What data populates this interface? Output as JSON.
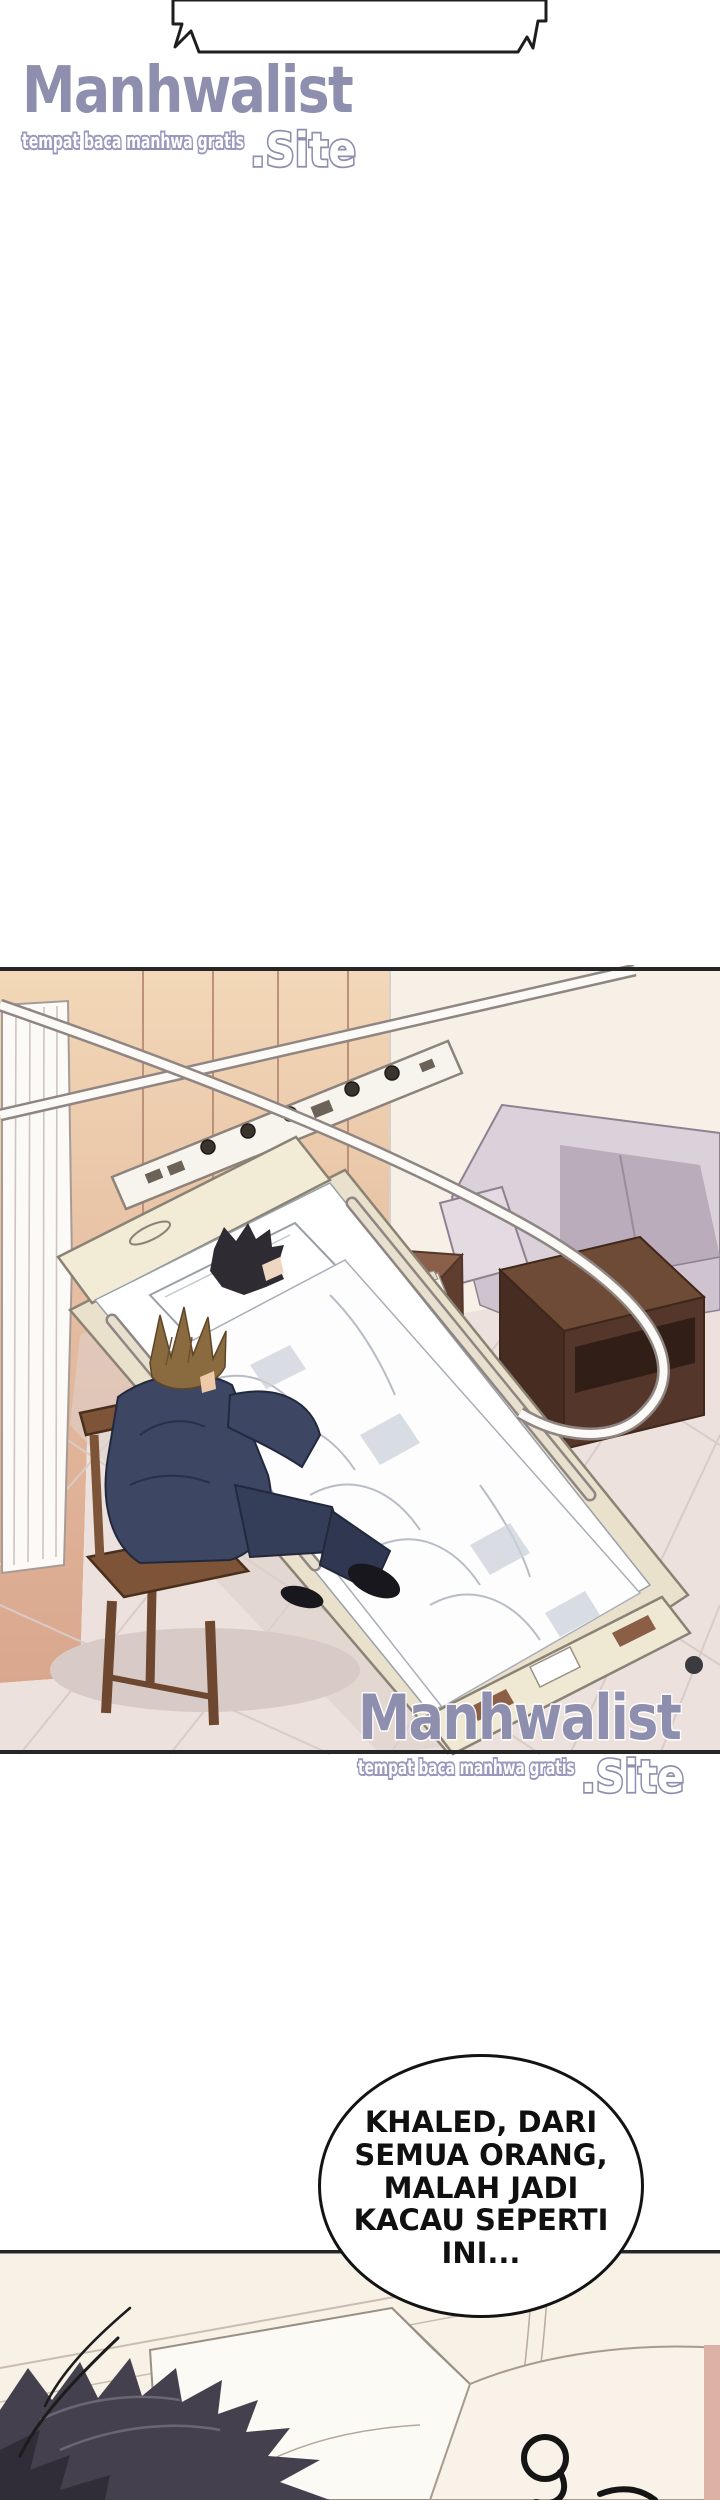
{
  "watermark": {
    "name": "Manhwalist",
    "tagline": "tempat baca manhwa gratis",
    "suffix": ".Site"
  },
  "speech_bubble": {
    "text": "KHALED, DARI\nSEMUA ORANG,\nMALAH JADI\nKACAU SEPERTI\nINI..."
  },
  "colors": {
    "ink": "#1e1e1e",
    "logo_purple": "#8e8eae",
    "logo_outline": "#ffffff",
    "wall_tan_top": "#f2d8b8",
    "wall_tan_bottom": "#d9a78e",
    "wall_white": "#f6f0e7",
    "floor": "#ece1dd",
    "tile_line": "#d9cbc7",
    "sofa": "#dbd1da",
    "sofa_shadow": "#b4a6b4",
    "wood_nightstand": "#7a5340",
    "cabinet_dark": "#54372a",
    "bed_frame": "#e9e1cb",
    "blanket_white": "#fdfdfe",
    "suit_navy": "#3d4662",
    "visitor_hair_brown": "#8a6a3f",
    "patient_hair_dark": "#2f2b33",
    "panel_cream": "#f8f1e6",
    "bottom_hair_dark": "#45404d"
  }
}
